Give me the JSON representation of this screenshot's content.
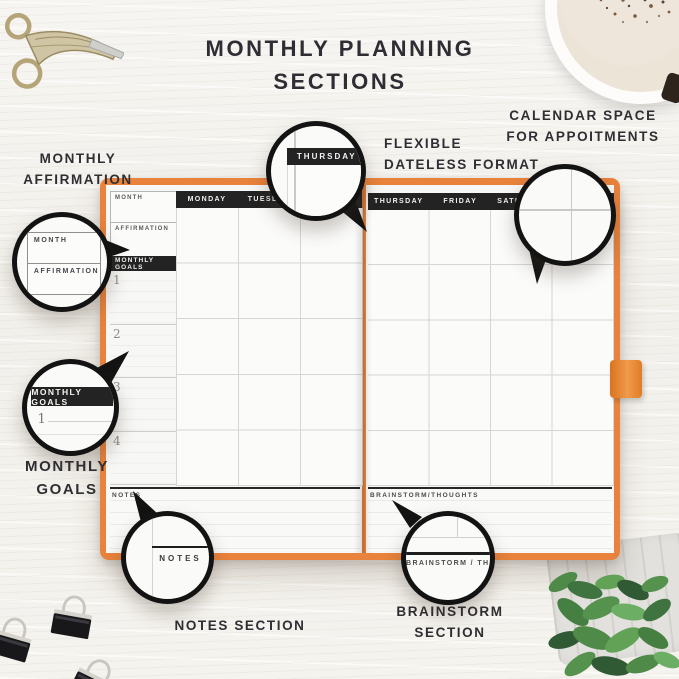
{
  "page": {
    "title_line1": "MONTHLY PLANNING",
    "title_line2": "SECTIONS"
  },
  "annotations": {
    "monthly_affirmation": {
      "line1": "MONTHLY",
      "line2": "AFFIRMATION"
    },
    "flexible_format": {
      "line1": "FLEXIBLE",
      "line2": "DATELESS FORMAT"
    },
    "calendar_space": {
      "line1": "CALENDAR SPACE",
      "line2": "FOR APPOITMENTS"
    },
    "monthly_goals": {
      "line1": "MONTHLY",
      "line2": "GOALS"
    },
    "notes": {
      "line1": "NOTES SECTION"
    },
    "brainstorm": {
      "line1": "BRAINSTORM",
      "line2": "SECTION"
    }
  },
  "planner": {
    "cover_color": "#e8823c",
    "left_page": {
      "month_box": "MONTH",
      "affirmation_box": "AFFIRMATION",
      "weekdays": [
        "MONDAY",
        "TUESDAY"
      ],
      "goals_bar": "MONTHLY GOALS",
      "goal_numbers": [
        "1",
        "2",
        "3",
        "4"
      ],
      "notes_label": "NOTES"
    },
    "right_page": {
      "weekdays": [
        "THURSDAY",
        "FRIDAY",
        "SATURDAY"
      ],
      "brainstorm_label": "BRAINSTORM/THOUGHTS"
    }
  },
  "callouts": {
    "thursday": {
      "label": "THURSDAY"
    },
    "month": {
      "month_label": "MONTH",
      "affirmation_label": "AFFIRMATION"
    },
    "goals": {
      "label": "MONTHLY GOALS",
      "number": "1"
    },
    "notes": {
      "label": "NOTES"
    },
    "brainstorm": {
      "label": "BRAINSTORM / THOUGH"
    }
  },
  "colors": {
    "accent_orange": "#e8823c",
    "bar_black": "#232323",
    "ring_black": "#131313",
    "text_dark": "#2f2e33"
  }
}
